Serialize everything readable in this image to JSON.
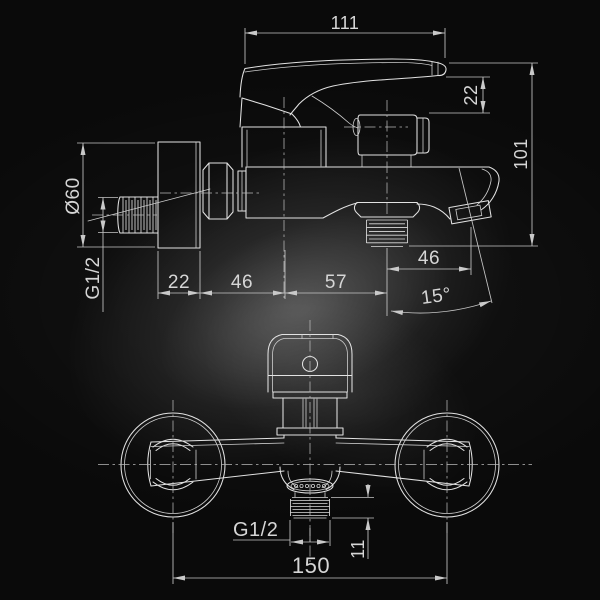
{
  "drawing": {
    "type": "technical-drawing",
    "subject": "wall-mounted bath shower mixer faucet",
    "colors": {
      "background": "#0a0a0a",
      "line": "#e2e2e2",
      "dimension": "#c6c6c6",
      "text": "#d6d6d6"
    },
    "top_view": {
      "dims": {
        "width": "111",
        "handle_drop": "22",
        "height": "101",
        "flange_dia": "Ø60",
        "inlet_thread": "G1/2",
        "wall_offset": "22",
        "inlet_to_center": "46",
        "center_to_outlet": "57",
        "outlet_to_spout": "46",
        "spout_angle": "15°"
      }
    },
    "front_view": {
      "dims": {
        "outlet_thread": "G1/2",
        "thread_length": "11",
        "flange_centers": "150"
      }
    }
  }
}
